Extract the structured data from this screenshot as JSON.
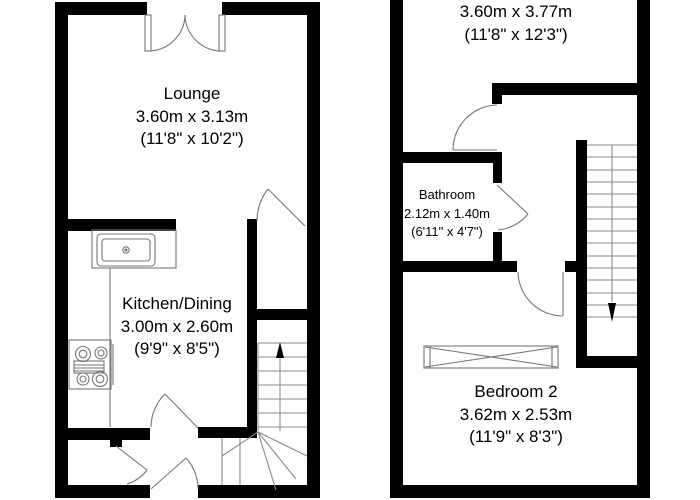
{
  "floorplan": {
    "rooms": {
      "lounge": {
        "name": "Lounge",
        "metric": "3.60m x 3.13m",
        "imperial": "(11'8\" x 10'2\")"
      },
      "kitchen": {
        "name": "Kitchen/Dining",
        "metric": "3.00m x 2.60m",
        "imperial": "(9'9\" x 8'5\")"
      },
      "bedroom1": {
        "metric": "3.60m x 3.77m",
        "imperial": "(11'8\" x 12'3\")"
      },
      "bathroom": {
        "name": "Bathroom",
        "metric": "2.12m x 1.40m",
        "imperial": "(6'11\" x 4'7\")"
      },
      "bedroom2": {
        "name": "Bedroom 2",
        "metric": "3.62m x 2.53m",
        "imperial": "(11'9\" x 8'3\")"
      }
    },
    "colors": {
      "wall": "#000000",
      "symbol": "#777777",
      "background": "#ffffff",
      "text": "#000000"
    }
  }
}
